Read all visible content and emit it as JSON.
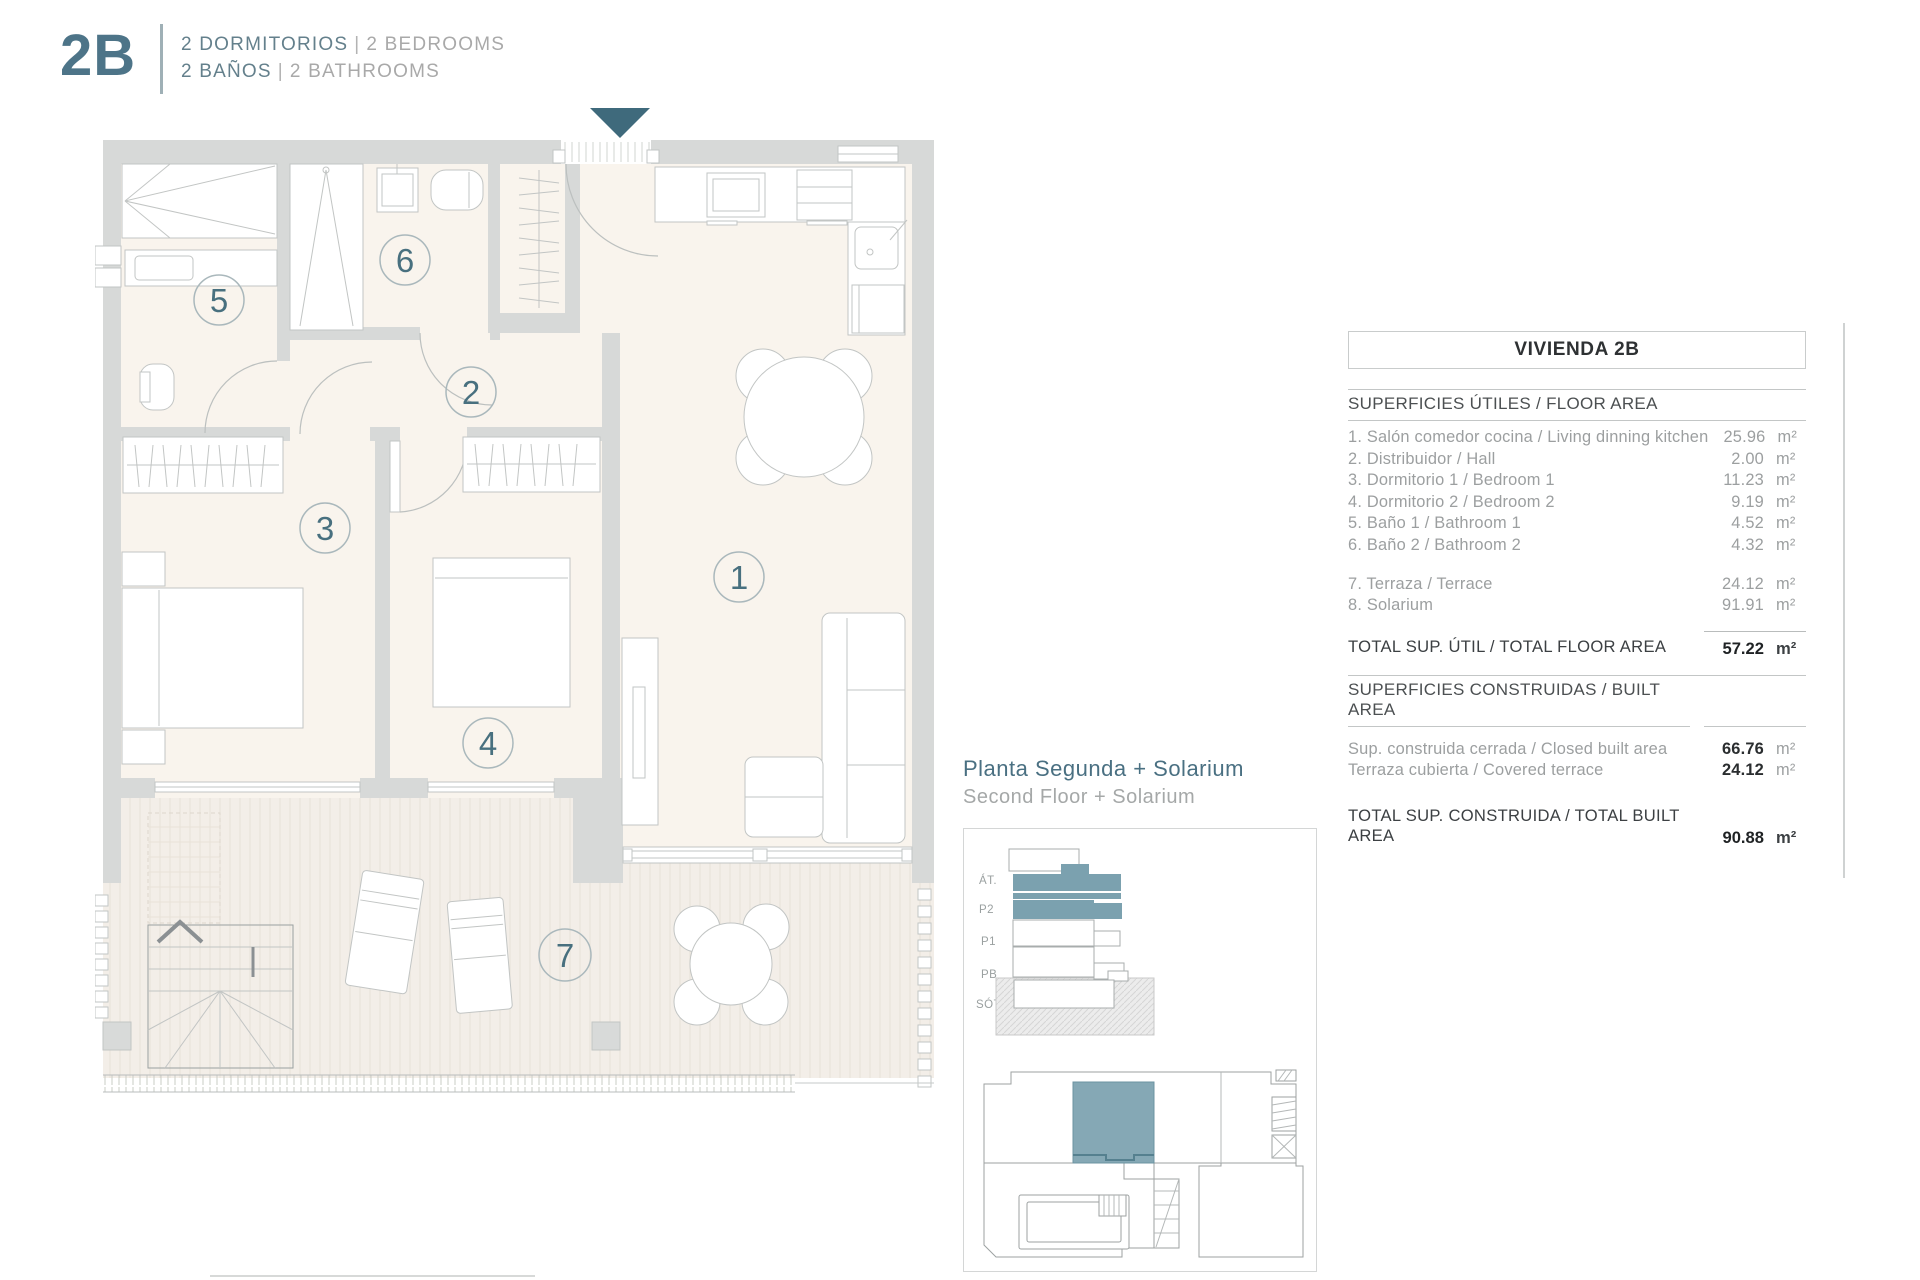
{
  "header": {
    "unit": "2B",
    "rooms_primary": "2 DORMITORIOS",
    "rooms_secondary": "2 BEDROOMS",
    "baths_primary": "2 BAÑOS",
    "baths_secondary": "2 BATHROOMS",
    "separator": "|"
  },
  "plan": {
    "rooms": [
      "1",
      "2",
      "3",
      "4",
      "5",
      "6",
      "7"
    ]
  },
  "floor_label": {
    "es": "Planta Segunda + Solarium",
    "en": "Second Floor + Solarium"
  },
  "section_diagram": {
    "levels": [
      "ÁT.",
      "P2",
      "P1",
      "PB",
      "SÓT."
    ]
  },
  "area_table": {
    "title": "VIVIENDA 2B",
    "floor_section_title": "SUPERFICIES ÚTILES / FLOOR AREA",
    "floor_rows": [
      {
        "label": "1. Salón comedor cocina / Living dinning kitchen",
        "value": "25.96",
        "unit": "m²"
      },
      {
        "label": "2. Distribuidor / Hall",
        "value": "2.00",
        "unit": "m²"
      },
      {
        "label": "3. Dormitorio 1 / Bedroom 1",
        "value": "11.23",
        "unit": "m²"
      },
      {
        "label": "4. Dormitorio 2 / Bedroom 2",
        "value": "9.19",
        "unit": "m²"
      },
      {
        "label": "5. Baño 1 / Bathroom 1",
        "value": "4.52",
        "unit": "m²"
      },
      {
        "label": "6. Baño 2 / Bathroom 2",
        "value": "4.32",
        "unit": "m²"
      },
      {
        "label": "7. Terraza / Terrace",
        "value": "24.12",
        "unit": "m²"
      },
      {
        "label": "8. Solarium",
        "value": "91.91",
        "unit": "m²"
      }
    ],
    "floor_total": {
      "label": "TOTAL SUP. ÚTIL / TOTAL FLOOR AREA",
      "value": "57.22",
      "unit": "m²"
    },
    "built_section_title": "SUPERFICIES CONSTRUIDAS / BUILT AREA",
    "built_rows": [
      {
        "label": "Sup. construida cerrada / Closed built area",
        "value": "66.76",
        "unit": "m²"
      },
      {
        "label": "Terraza cubierta / Covered terrace",
        "value": "24.12",
        "unit": "m²"
      }
    ],
    "built_total": {
      "label": "TOTAL SUP. CONSTRUIDA /  TOTAL BUILT AREA",
      "value": "90.88",
      "unit": "m²"
    }
  },
  "colors": {
    "accent": "#4d7488",
    "highlight": "#7ba1af",
    "wall": "#d7d9d8"
  }
}
